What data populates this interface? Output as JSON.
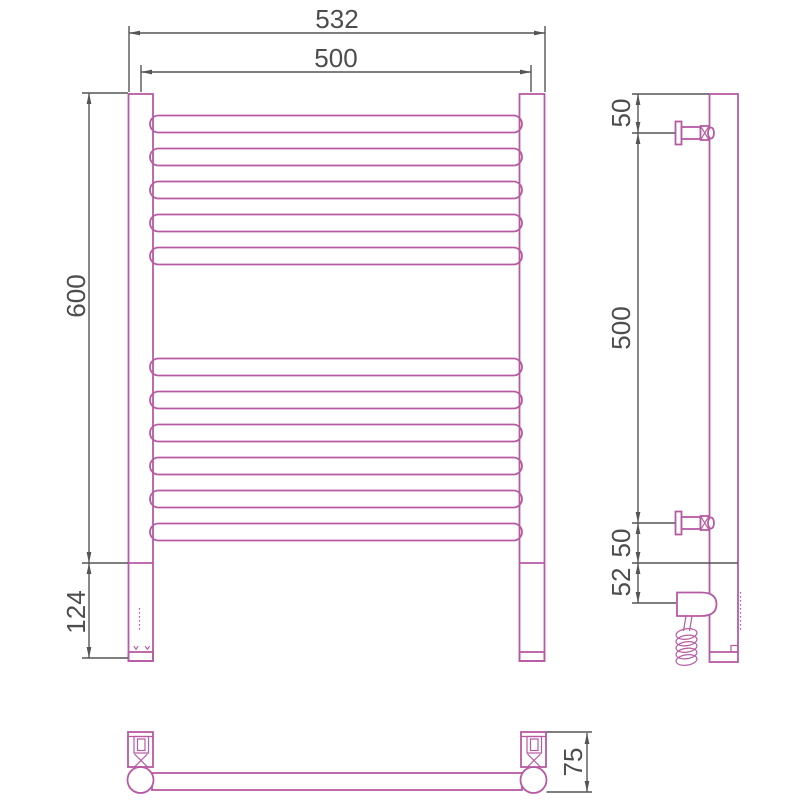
{
  "views": {
    "front": {
      "dim_overall_width": "532",
      "dim_rail_width": "500",
      "dim_height": "600",
      "dim_lower_section": "124",
      "top_rungs": 5,
      "bottom_rungs": 6
    },
    "side": {
      "dim_top_bracket_offset": "50",
      "dim_bracket_spacing": "500",
      "dim_lower_bracket_offset": "50",
      "dim_base_offset": "52"
    },
    "bottom": {
      "dim_depth": "75"
    }
  },
  "colors": {
    "outline": "#b75aa4",
    "dimension": "#555555",
    "label_text": "#4d4d4d",
    "background": "#ffffff"
  }
}
